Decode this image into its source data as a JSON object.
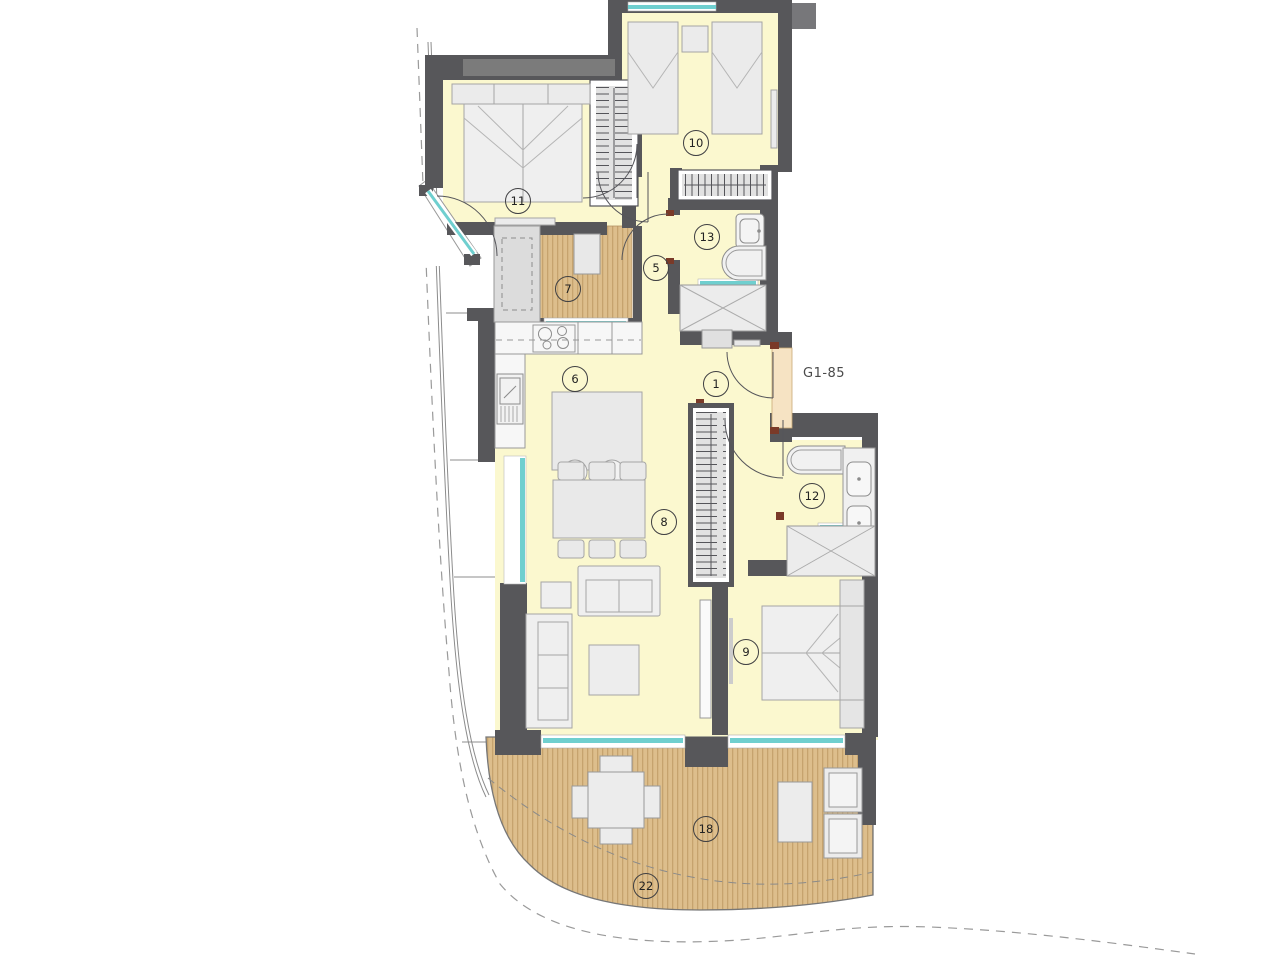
{
  "plan": {
    "unit_label": "G1-85",
    "markers": [
      {
        "id": "room-1",
        "number": "1"
      },
      {
        "id": "room-5",
        "number": "5"
      },
      {
        "id": "room-6",
        "number": "6"
      },
      {
        "id": "room-7",
        "number": "7"
      },
      {
        "id": "room-8",
        "number": "8"
      },
      {
        "id": "room-9",
        "number": "9"
      },
      {
        "id": "room-10",
        "number": "10"
      },
      {
        "id": "room-11",
        "number": "11"
      },
      {
        "id": "room-12",
        "number": "12"
      },
      {
        "id": "room-13",
        "number": "13"
      },
      {
        "id": "room-18",
        "number": "18"
      },
      {
        "id": "room-22",
        "number": "22"
      }
    ],
    "colors": {
      "wall": "#57575A",
      "wall_light": "#7B7B7B",
      "floor": "#FBF8CF",
      "deck": "#DDBE8C",
      "deck_stripe": "#C6A36E",
      "window_glass": "#6FCFCF",
      "threshold": "#F6E3C3",
      "furniture": "#EBEBEB",
      "boundary_dash": "#999999"
    }
  }
}
